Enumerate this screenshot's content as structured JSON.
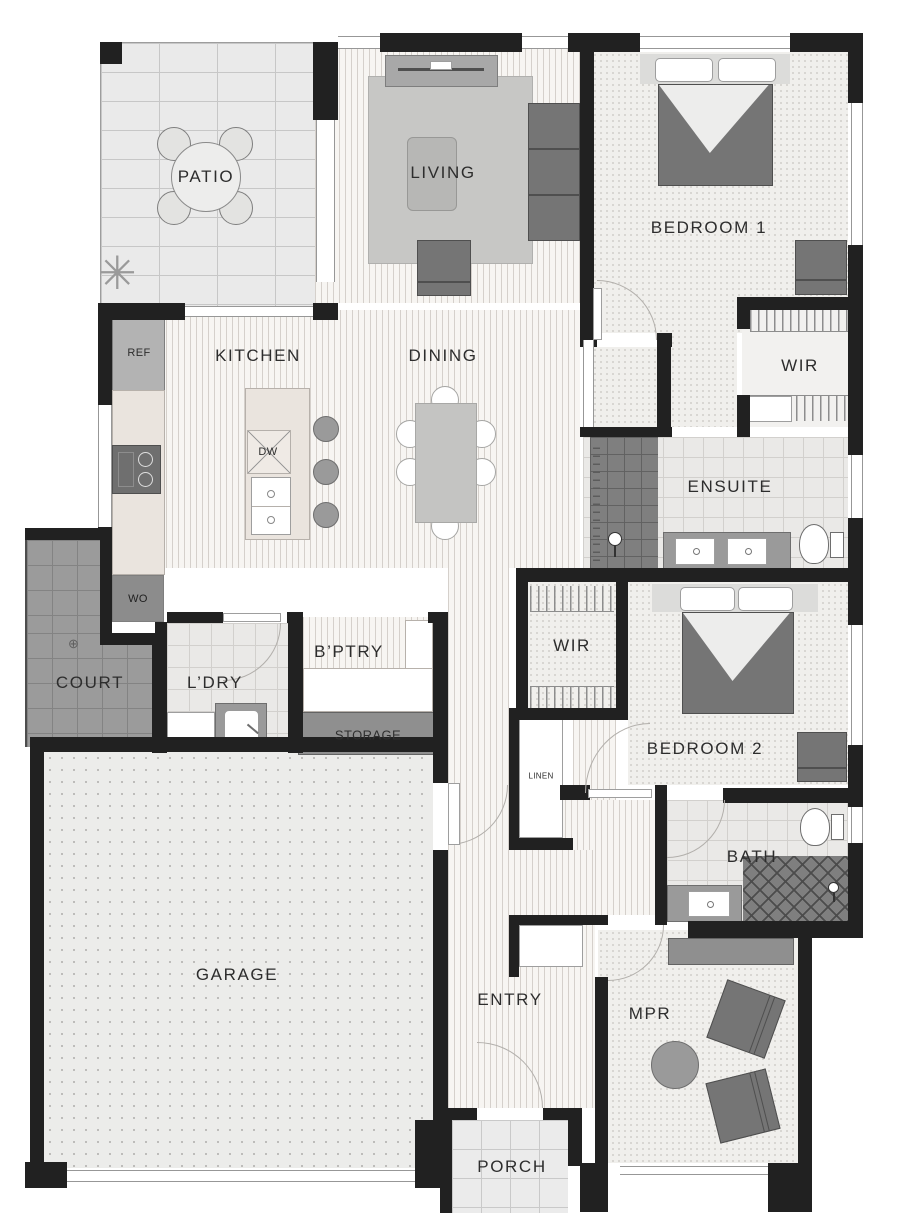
{
  "title": "House floor plan",
  "rooms": {
    "patio": {
      "label": "PATIO"
    },
    "living": {
      "label": "LIVING"
    },
    "bedroom1": {
      "label": "BEDROOM 1"
    },
    "wir1": {
      "label": "WIR"
    },
    "ensuite": {
      "label": "ENSUITE"
    },
    "kitchen": {
      "label": "KITCHEN"
    },
    "dining": {
      "label": "DINING"
    },
    "court": {
      "label": "COURT"
    },
    "laundry": {
      "label": "L’DRY"
    },
    "butlers_pantry": {
      "label": "B’PTRY"
    },
    "storage": {
      "label": "STORAGE"
    },
    "wir2": {
      "label": "WIR"
    },
    "bedroom2": {
      "label": "BEDROOM 2"
    },
    "linen": {
      "label": "LINEN"
    },
    "bath": {
      "label": "BATH"
    },
    "garage": {
      "label": "GARAGE"
    },
    "entry": {
      "label": "ENTRY"
    },
    "mpr": {
      "label": "MPR"
    },
    "porch": {
      "label": "PORCH"
    }
  },
  "appliances": {
    "fridge": "REF",
    "wall_oven": "WO",
    "dishwasher": "DW"
  },
  "icons": {
    "plant": "✳",
    "drain": "⊕"
  },
  "colors": {
    "wall": "#212121",
    "court_tile": "#9b9b9b",
    "shower_tile": "#7f7f7f",
    "storage_fill": "#8f8f8f",
    "furniture_dark": "#757575",
    "furniture_light": "#a8a8a8",
    "rug": "#c7c7c5",
    "bench": "#eae4de",
    "carpet": "#f0efec",
    "timber": "#f7f5f2",
    "patio_tile": "#eaeaea"
  }
}
